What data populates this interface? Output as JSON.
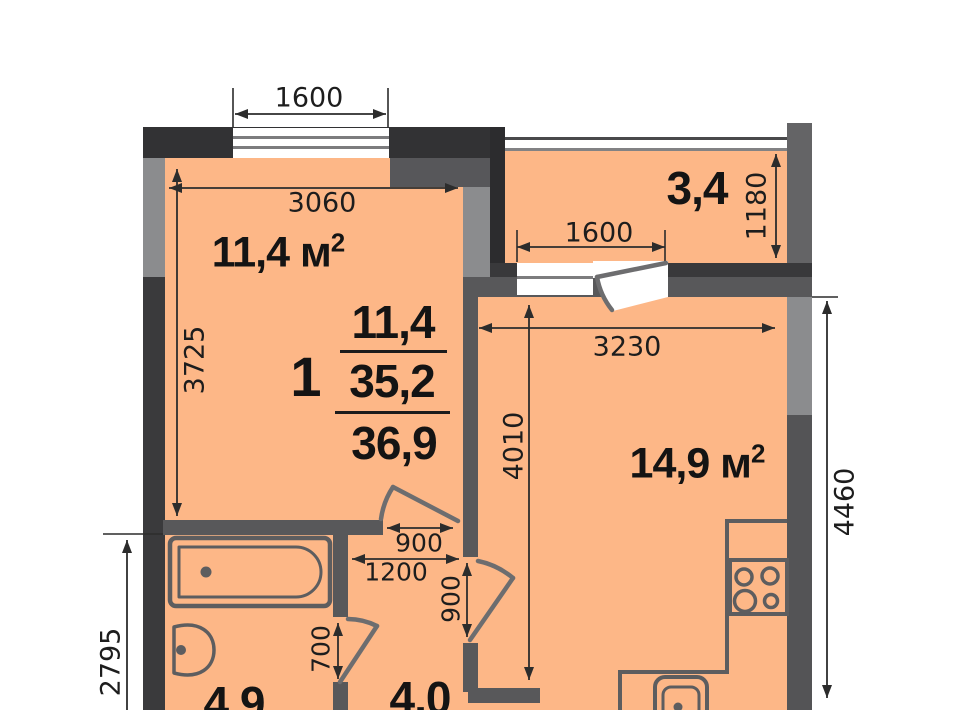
{
  "plan": {
    "summary": {
      "rooms_count": "1",
      "living_area": "11,4",
      "living_total": "35,2",
      "total_area": "36,9"
    },
    "rooms": {
      "living": {
        "area": "11,4 м",
        "sup": "2"
      },
      "kitchen": {
        "area": "14,9 м",
        "sup": "2"
      },
      "balcony": {
        "area": "3,4"
      },
      "bathroom": {
        "area": "4,9"
      },
      "hallway": {
        "area": "4,0"
      }
    },
    "dimensions": {
      "top_window": "1600",
      "living_width": "3060",
      "living_height": "3725",
      "balcony_depth": "1180",
      "balcony_window": "1600",
      "kitchen_width": "3230",
      "kitchen_height": "4010",
      "right_side": "4460",
      "living_door": "900",
      "hallway_width": "1200",
      "kitchen_door": "900",
      "bathroom_door": "700",
      "left_lower": "2795"
    },
    "colors": {
      "room_fill": "#fdb787",
      "wall_dark": "#333335",
      "wall_mid": "#58585a",
      "wall_light": "#8b8c8e"
    }
  }
}
